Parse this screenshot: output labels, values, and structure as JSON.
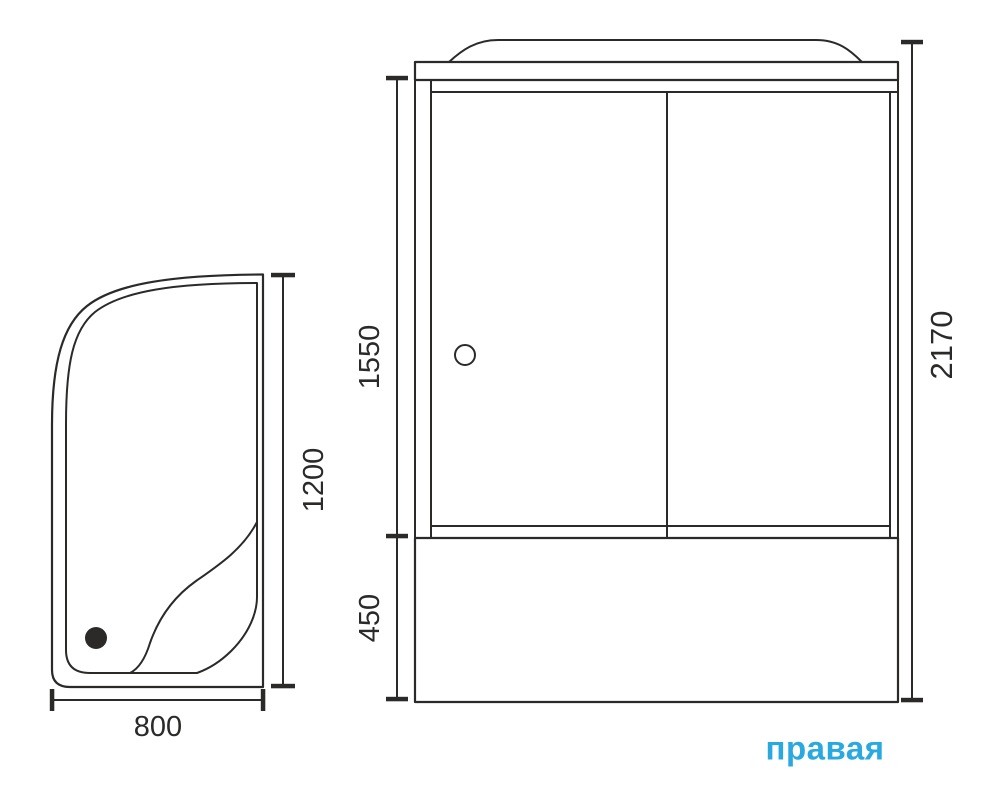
{
  "drawing": {
    "orientation_label": "правая",
    "colors": {
      "line": "#2b2a29",
      "accent": "#29a9e0"
    },
    "top_view": {
      "width_label": "800",
      "depth_label": "1200"
    },
    "front_view": {
      "glass_section_label": "1550",
      "tub_section_label": "450",
      "total_height_label": "2170"
    }
  }
}
